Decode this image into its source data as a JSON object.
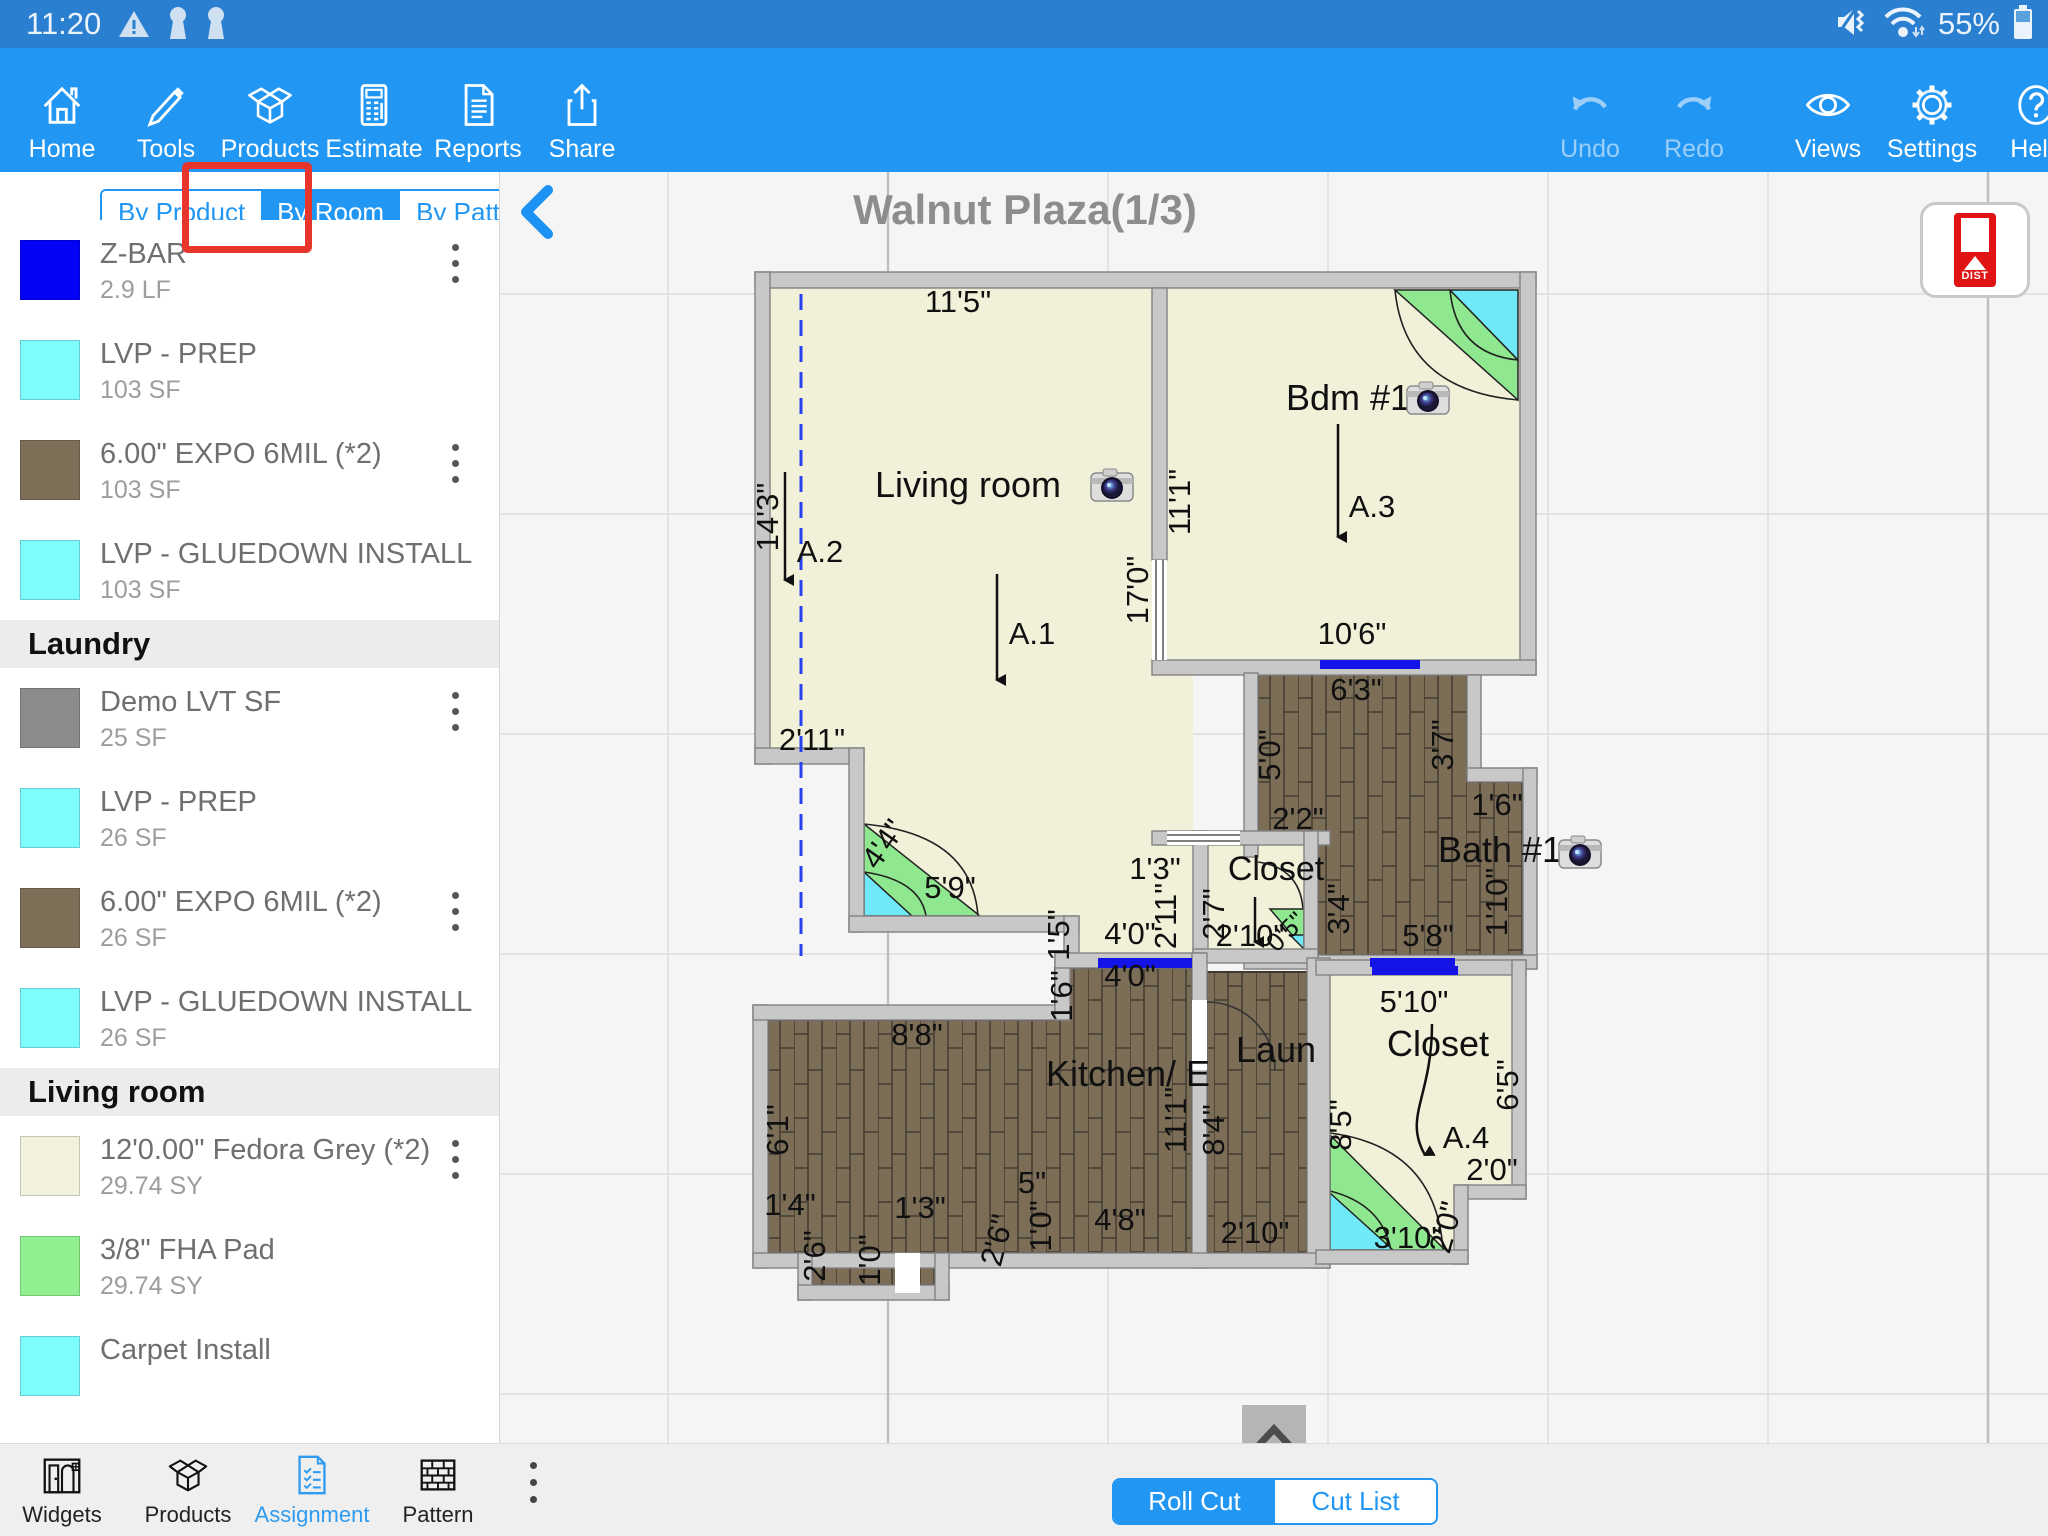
{
  "status_bar": {
    "time": "11:20",
    "battery_pct": "55%"
  },
  "toolbar": {
    "left": [
      {
        "label": "Home"
      },
      {
        "label": "Tools"
      },
      {
        "label": "Products"
      },
      {
        "label": "Estimate"
      },
      {
        "label": "Reports"
      },
      {
        "label": "Share"
      }
    ],
    "right": [
      {
        "label": "Undo"
      },
      {
        "label": "Redo"
      },
      {
        "label": "Views"
      },
      {
        "label": "Settings"
      },
      {
        "label": "Help"
      }
    ]
  },
  "sidebar": {
    "tabs": [
      {
        "label": "By Product"
      },
      {
        "label": "By Room"
      },
      {
        "label": "By Pattern"
      }
    ],
    "active_tab": "By Room",
    "sections": [
      {
        "title": "Kitchen/ Entry",
        "items": [
          {
            "title": "Z-BAR",
            "qty": "2.9 LF",
            "color": "#0202f5",
            "menu": true
          },
          {
            "title": "LVP - PREP",
            "qty": "103 SF",
            "color": "#7dfdfd",
            "menu": false
          },
          {
            "title": "6.00\" EXPO 6MIL  (*2)",
            "qty": "103 SF",
            "color": "#7d6e58",
            "menu": true
          },
          {
            "title": "LVP - GLUEDOWN INSTALL",
            "qty": "103 SF",
            "color": "#7dfdfd",
            "menu": false
          }
        ]
      },
      {
        "title": "Laundry",
        "items": [
          {
            "title": "Demo LVT SF",
            "qty": "25 SF",
            "color": "#8c8c8c",
            "menu": true
          },
          {
            "title": "LVP - PREP",
            "qty": "26 SF",
            "color": "#7dfdfd",
            "menu": false
          },
          {
            "title": "6.00\" EXPO 6MIL  (*2)",
            "qty": "26 SF",
            "color": "#7d6e58",
            "menu": true
          },
          {
            "title": "LVP - GLUEDOWN INSTALL",
            "qty": "26 SF",
            "color": "#7dfdfd",
            "menu": false
          }
        ]
      },
      {
        "title": "Living room",
        "items": [
          {
            "title": "12'0.00\" Fedora Grey  (*2)",
            "qty": "29.74 SY",
            "color": "#f2f2dc",
            "menu": true
          },
          {
            "title": "3/8\" FHA Pad",
            "qty": "29.74 SY",
            "color": "#90f090",
            "menu": false
          },
          {
            "title": "Carpet Install",
            "qty": "",
            "color": "#7dfdfd",
            "menu": false
          }
        ]
      }
    ]
  },
  "canvas": {
    "title": "Walnut Plaza(1/3)",
    "dist_button": "DIST"
  },
  "bottom_nav": {
    "items": [
      {
        "label": "Widgets"
      },
      {
        "label": "Products"
      },
      {
        "label": "Assignment"
      },
      {
        "label": "Pattern"
      }
    ],
    "active": "Assignment"
  },
  "cut_toggle": {
    "options": [
      {
        "label": "Roll Cut"
      },
      {
        "label": "Cut List"
      }
    ],
    "active": "Roll Cut"
  },
  "floorplan": {
    "labels": [
      {
        "t": "11'5\"",
        "x": 458,
        "y": 140
      },
      {
        "t": "14'3\"",
        "x": 278,
        "y": 345,
        "r": -90
      },
      {
        "t": "A.2",
        "x": 320,
        "y": 390
      },
      {
        "t": "Living room",
        "x": 468,
        "y": 325,
        "s": 36
      },
      {
        "t": "A.1",
        "x": 532,
        "y": 472
      },
      {
        "t": "2'11\"",
        "x": 312,
        "y": 578
      },
      {
        "t": "4'4\"",
        "x": 392,
        "y": 678,
        "r": -55
      },
      {
        "t": "5'9\"",
        "x": 450,
        "y": 726
      },
      {
        "t": "11'1\"",
        "x": 690,
        "y": 330,
        "r": -90
      },
      {
        "t": "17'0\"",
        "x": 648,
        "y": 418,
        "r": -90
      },
      {
        "t": "Bdm #1",
        "x": 848,
        "y": 238,
        "s": 36
      },
      {
        "t": "A.3",
        "x": 872,
        "y": 345
      },
      {
        "t": "10'6\"",
        "x": 852,
        "y": 472
      },
      {
        "t": "6'3\"",
        "x": 856,
        "y": 528
      },
      {
        "t": "5'0\"",
        "x": 780,
        "y": 583,
        "r": -90
      },
      {
        "t": "3'7\"",
        "x": 953,
        "y": 573,
        "r": -90
      },
      {
        "t": "2'2\"",
        "x": 798,
        "y": 657
      },
      {
        "t": "1'6\"",
        "x": 997,
        "y": 643
      },
      {
        "t": "Bath #1",
        "x": 1000,
        "y": 690,
        "s": 36
      },
      {
        "t": "1'10\"",
        "x": 1007,
        "y": 730,
        "r": -90
      },
      {
        "t": "3'4\"",
        "x": 849,
        "y": 737,
        "r": -90
      },
      {
        "t": "5'8\"",
        "x": 928,
        "y": 774
      },
      {
        "t": "1'3\"",
        "x": 655,
        "y": 707
      },
      {
        "t": "2'11\"",
        "x": 676,
        "y": 744,
        "r": -90
      },
      {
        "t": "Closet",
        "x": 776,
        "y": 708,
        "s": 34
      },
      {
        "t": "2'7\"",
        "x": 724,
        "y": 742,
        "r": -90
      },
      {
        "t": "2'10\"",
        "x": 750,
        "y": 774
      },
      {
        "t": "0'5\"",
        "x": 792,
        "y": 766,
        "r": -45,
        "s": 26
      },
      {
        "t": "1'5\"",
        "x": 569,
        "y": 763,
        "r": -90
      },
      {
        "t": "4'0\"",
        "x": 630,
        "y": 772
      },
      {
        "t": "4'0\"",
        "x": 630,
        "y": 814
      },
      {
        "t": "1'6\"",
        "x": 572,
        "y": 824,
        "r": -90
      },
      {
        "t": "8'8\"",
        "x": 417,
        "y": 873
      },
      {
        "t": "Kitchen/ E",
        "x": 628,
        "y": 914,
        "s": 36
      },
      {
        "t": "6'1\"",
        "x": 288,
        "y": 958,
        "r": -90
      },
      {
        "t": "11'1\"",
        "x": 686,
        "y": 948,
        "r": -90
      },
      {
        "t": "8'4\"",
        "x": 724,
        "y": 958,
        "r": -90
      },
      {
        "t": "Laun",
        "x": 776,
        "y": 890,
        "s": 36
      },
      {
        "t": "5'10\"",
        "x": 914,
        "y": 840
      },
      {
        "t": "Closet",
        "x": 938,
        "y": 884,
        "s": 36
      },
      {
        "t": "6'5\"",
        "x": 1018,
        "y": 913,
        "r": -90
      },
      {
        "t": "8'5\"",
        "x": 851,
        "y": 953,
        "r": -90
      },
      {
        "t": "A.4",
        "x": 966,
        "y": 976
      },
      {
        "t": "2'0\"",
        "x": 992,
        "y": 1008
      },
      {
        "t": "2'0\"",
        "x": 956,
        "y": 1058,
        "r": -75
      },
      {
        "t": "3'10\"",
        "x": 908,
        "y": 1076
      },
      {
        "t": "2'10\"",
        "x": 755,
        "y": 1071
      },
      {
        "t": "1'4\"",
        "x": 290,
        "y": 1043
      },
      {
        "t": "1'3\"",
        "x": 420,
        "y": 1046
      },
      {
        "t": "5\"",
        "x": 532,
        "y": 1021
      },
      {
        "t": "1'0\"",
        "x": 551,
        "y": 1054,
        "r": -90
      },
      {
        "t": "4'8\"",
        "x": 620,
        "y": 1058
      },
      {
        "t": "2'6\"",
        "x": 507,
        "y": 1071,
        "r": -75
      },
      {
        "t": "2'6\"",
        "x": 325,
        "y": 1084,
        "r": -90
      },
      {
        "t": "1'0\"",
        "x": 380,
        "y": 1088,
        "r": -90
      }
    ],
    "arrows": [
      {
        "x1": 497,
        "y1": 402,
        "x2": 497,
        "y2": 508
      },
      {
        "x1": 285,
        "y1": 300,
        "x2": 285,
        "y2": 408
      },
      {
        "x1": 838,
        "y1": 252,
        "x2": 838,
        "y2": 365
      },
      {
        "path": "M932,852 C932,925 903,945 925,983"
      },
      {
        "x1": 755,
        "y1": 725,
        "x2": 755,
        "y2": 770
      }
    ],
    "cameras": [
      {
        "x": 612,
        "y": 313
      },
      {
        "x": 928,
        "y": 226
      },
      {
        "x": 1080,
        "y": 680
      }
    ]
  }
}
